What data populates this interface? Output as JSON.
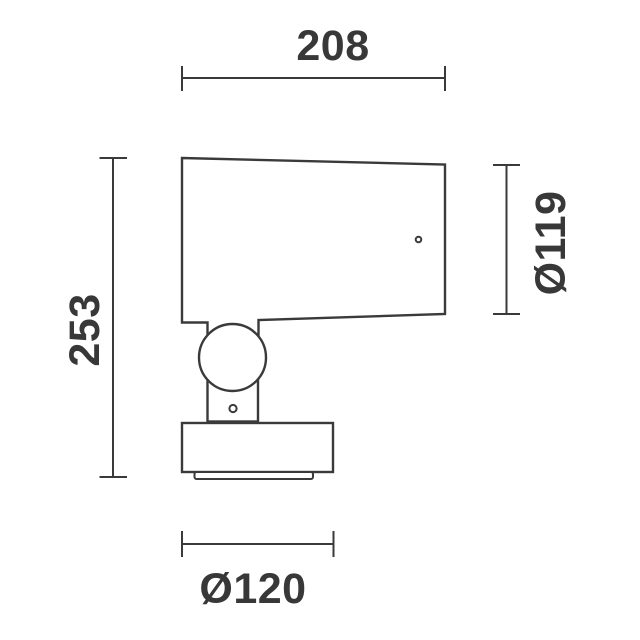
{
  "diagram": {
    "kind": "technical-dimension-drawing",
    "colors": {
      "line": "#3a3a3a",
      "text": "#383838",
      "background": "#ffffff"
    },
    "dimensions": {
      "width": {
        "label": "208"
      },
      "height": {
        "label": "253"
      },
      "head_diameter": {
        "label": "Ø119"
      },
      "base_diameter": {
        "label": "Ø120"
      }
    }
  }
}
